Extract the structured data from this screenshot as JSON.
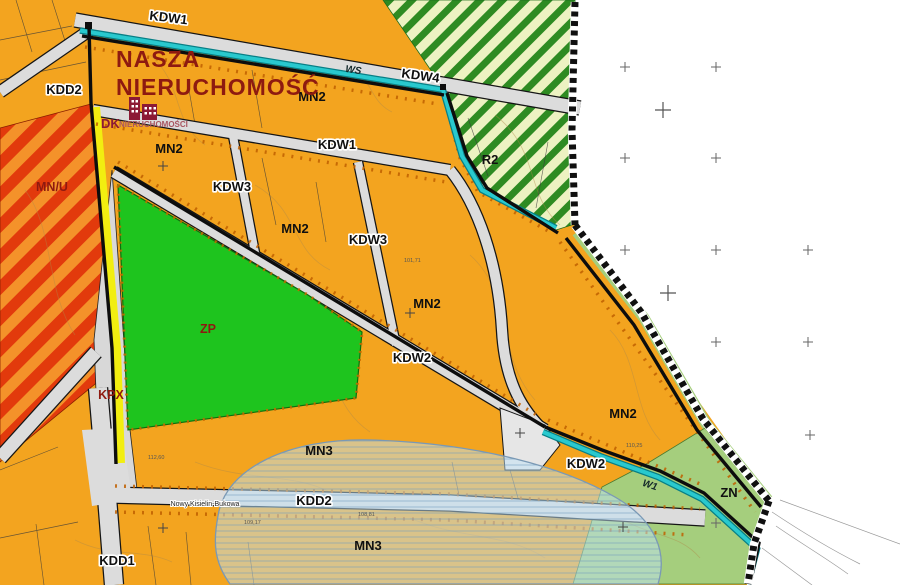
{
  "title": {
    "line1": "NASZA",
    "line2": "NIERUCHOMOŚĆ"
  },
  "brand": {
    "abbr": "DK",
    "name": "NIERUCHOMOŚCI"
  },
  "zone_labels": {
    "mn2": "MN2",
    "mn3": "MN3",
    "mnu": "MN/U",
    "zp": "ZP",
    "zn": "ZN",
    "r2": "R2",
    "kpx": "KPX",
    "w1": "W1",
    "ws": "WS"
  },
  "road_labels": {
    "kdw1": "KDW1",
    "kdw2": "KDW2",
    "kdw3": "KDW3",
    "kdw4": "KDW4",
    "kdd1": "KDD1",
    "kdd2": "KDD2"
  },
  "street_name": "Nowy Kisielin-Bukowa",
  "spot_elevations": [
    "112,60",
    "108,81",
    "101,71",
    "110,25",
    "109,17"
  ],
  "colors": {
    "residential_orange": "#F3A41F",
    "park_green": "#1EC41E",
    "farmland_light": "#EDF2C2",
    "farmland_stripe": "#2E8B22",
    "services_stripe_red": "#E23A0C",
    "services_bg_orange": "#F4922A",
    "nature_green": "#A5CE7D",
    "water_teal": "#29C9CE",
    "path_yellow": "#F2EE10",
    "road_gray": "#DCDCDC",
    "boundary_black": "#0D0D0D",
    "flood_blue": "#BFE2F5",
    "title_red": "#8E1A10"
  }
}
